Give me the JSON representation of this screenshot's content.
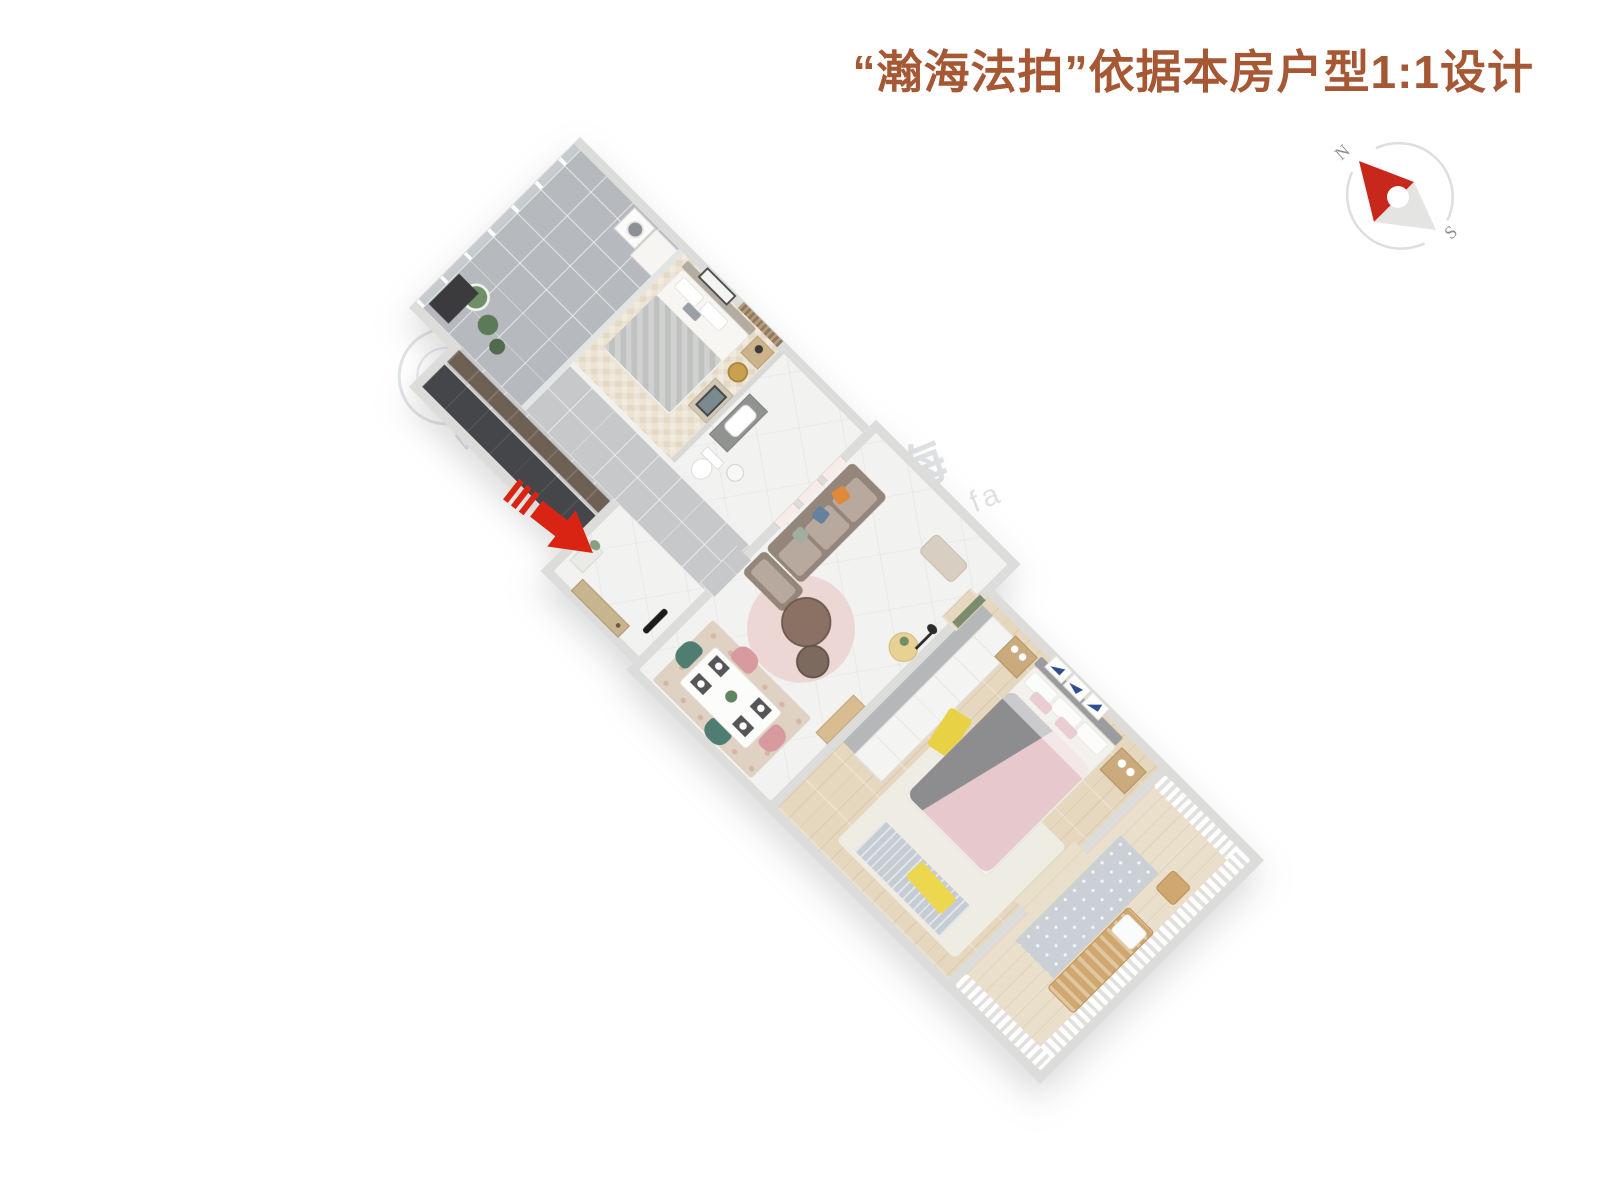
{
  "header": {
    "title": "“瀚海法拍”依据本房户型1:1设计",
    "title_color": "#A65733"
  },
  "compass": {
    "north_label": "N",
    "south_label": "S",
    "needle_color": "#C8271B",
    "tail_color": "#E4E4E2",
    "ring_color": "#DEDEDC",
    "label_color": "#8F8F8F"
  },
  "entrance": {
    "arrow_color": "#DA2413",
    "direction": "points-to-entry-door"
  },
  "watermark": {
    "brand": "瀚海",
    "letters": "WWW",
    "url_text": "www.fa"
  },
  "floorplan": {
    "view": "3d-top-down-rotated",
    "rotation_deg": 45,
    "wall_color": "#DCDCDA",
    "rooms": [
      {
        "id": "balcony-north",
        "floor_color": "#B6BABE",
        "furniture": [
          "window-wall",
          "washing-machine",
          "laundry-cabinet",
          "potted-plants",
          "storage-cabinet"
        ]
      },
      {
        "id": "bedroom-north",
        "floor_color": "#ECE3D2",
        "furniture": [
          "double-bed-gray",
          "wall-art",
          "slat-feature-wall",
          "nightstand",
          "gold-tray-table",
          "dresser-with-art"
        ]
      },
      {
        "id": "bathroom",
        "floor_color": "#F2F2F0",
        "furniture": [
          "vanity-sink",
          "toilet",
          "side-stool"
        ]
      },
      {
        "id": "hallway-kitchen",
        "floor_color": "#C6C8CA",
        "furniture": [
          "kitchen-counter",
          "tall-dark-cabinets"
        ]
      },
      {
        "id": "entry-hall",
        "floor_color": "#F1F1EF",
        "furniture": [
          "entry-door",
          "console-with-flowers",
          "coat-stand"
        ]
      },
      {
        "id": "living-room",
        "floor_color": "#F1F1EF",
        "furniture": [
          "sofa",
          "orange-pillow",
          "blue-pillow",
          "round-pink-rug",
          "coffee-tables",
          "ottoman",
          "side-table-with-lamp",
          "wall-art-frames",
          "wood-console",
          "green-door"
        ]
      },
      {
        "id": "dining-area",
        "floor_color": "#F1F1EF",
        "furniture": [
          "dining-table",
          "pink-chairs",
          "green-chairs",
          "floral-rug",
          "place-settings",
          "table-plant"
        ]
      },
      {
        "id": "bedroom-south",
        "floor_color": "#E6D7BF",
        "furniture": [
          "wardrobe",
          "double-bed-pink",
          "gray-throw",
          "nightstands",
          "triangle-art-frames",
          "yellow-throw",
          "yellow-rug",
          "white-rug",
          "fringe-rug"
        ]
      },
      {
        "id": "balcony-south",
        "floor_color": "#EADFCA",
        "furniture": [
          "sheer-curtains",
          "wood-lounge-chair",
          "pattern-rug",
          "wood-stool"
        ]
      }
    ]
  }
}
